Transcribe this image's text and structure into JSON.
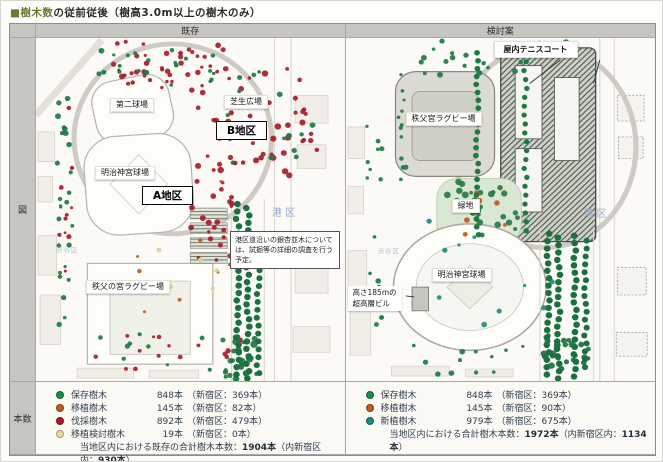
{
  "title": {
    "prefix": "■樹木数",
    "rest": "の従前従後（樹高3.0m以上の樹木のみ）"
  },
  "table": {
    "row_labels": {
      "map": "図",
      "count": "本数"
    },
    "columns": {
      "existing": "既存",
      "proposal": "検討案"
    }
  },
  "map_existing": {
    "labels": {
      "second_stadium": "第二球場",
      "lawn_plaza": "芝生広場",
      "district_b": "B地区",
      "jingu_stadium": "明治神宮球場",
      "district_a": "A地区",
      "rugby_stadium": "秩父の宮ラグビー場",
      "minato_ward": "港区",
      "shibuya_ward": "渋谷区",
      "note": "港区道沿いの銀杏並木については、試掘等の詳細の調査を行う予定。"
    }
  },
  "map_proposal": {
    "labels": {
      "indoor_tennis": "屋内テニスコート",
      "rugby_stadium": "秩父宮ラグビー場",
      "green_space": "緑地",
      "jingu_stadium": "明治神宮球場",
      "tower_line1": "高さ185mの",
      "tower_line2": "超高層ビル",
      "minato_ward": "港区",
      "shibuya_ward": "渋谷区"
    }
  },
  "legend_existing": {
    "items": [
      {
        "label": "保存樹木",
        "count": "848本",
        "ward": "（新宿区：369本）",
        "color": "#1e8a4c"
      },
      {
        "label": "移植樹木",
        "count": "145本",
        "ward": "（新宿区：82本）",
        "color": "#c05a1e"
      },
      {
        "label": "伐採樹木",
        "count": "892本",
        "ward": "（新宿区：479本）",
        "color": "#b01828"
      },
      {
        "label": "移植検討樹木",
        "count": "19本",
        "ward": "（新宿区：0本）",
        "color": "#e4dca2"
      }
    ],
    "total": {
      "prefix": "当地区内における既存の合計樹木本数：",
      "value": "1904本",
      "mid": "（内新宿区内：",
      "value2": "930本",
      "suffix": "）"
    }
  },
  "legend_proposal": {
    "items": [
      {
        "label": "保存樹木",
        "count": "848本",
        "ward": "（新宿区：369本）",
        "color": "#1e8a4c"
      },
      {
        "label": "移植樹木",
        "count": "145本",
        "ward": "（新宿区：90本）",
        "color": "#c05a1e"
      },
      {
        "label": "新植樹木",
        "count": "979本",
        "ward": "（新宿区：675本）",
        "color": "#1f8a80"
      }
    ],
    "total": {
      "prefix": "当地区内における合計樹木本数：",
      "value": "1972本",
      "mid": "（内新宿区内：",
      "value2": "1134本",
      "suffix": "）"
    }
  }
}
